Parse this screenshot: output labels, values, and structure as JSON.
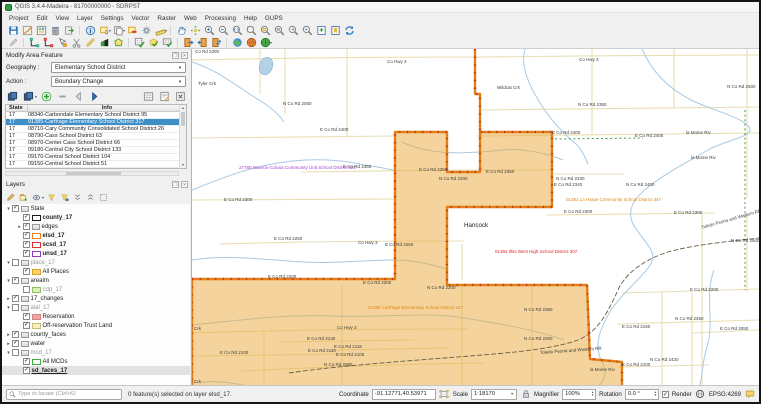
{
  "window": {
    "title": "QGIS 3.4.4-Madeira - 81700000000 - SDRPST"
  },
  "menu": {
    "items": [
      "Project",
      "Edit",
      "View",
      "Layer",
      "Settings",
      "Vector",
      "Raster",
      "Web",
      "Processing",
      "Help",
      "GUPS"
    ]
  },
  "toolbars": {
    "row1": [
      "project-save",
      "style-manager",
      "layout-manager",
      "delete-selected",
      "export-map",
      "|",
      "identify-features",
      "select-features",
      "copy-features",
      "deselect-features",
      "options-gear",
      "measure",
      "|",
      "pan-map",
      "pan-to-selection",
      "zoom-in",
      "zoom-out",
      "zoom-native",
      "zoom-full",
      "zoom-to-selection",
      "zoom-to-layer",
      "zoom-last",
      "zoom-next",
      "new-bookmark",
      "show-bookmarks",
      "map-refresh"
    ],
    "row2": [
      "toggle-editing",
      "|",
      "vertex-tool",
      "vertex-tool-active-layer",
      "modify-features",
      "cut-features",
      "measure-sketch",
      "snapping",
      "add-polygon",
      "|",
      "validate-grid",
      "review-polygon",
      "quality-grid",
      "|",
      "import-door",
      "export-door",
      "transfer-door",
      "|",
      "web-globe",
      "orange-sphere",
      "green-sphere"
    ]
  },
  "modify_panel": {
    "title": "Modify Area Feature",
    "geography_label": "Geography :",
    "geography_value": "Elementary School District",
    "action_label": "Action :",
    "action_value": "Boundary Change",
    "buttons": [
      "copy-selection",
      "copy-selection-menu",
      "add-area",
      "remove-area",
      "previous-feature",
      "next-feature",
      "spacer",
      "attribute-table",
      "edit-attributes",
      "close-tool"
    ],
    "table": {
      "columns": [
        "State",
        "Info"
      ],
      "selected_index": 1,
      "rows": [
        {
          "state": "17",
          "info": "08340-Carbondale Elementary School District 95"
        },
        {
          "state": "17",
          "info": "01385-Carthage Elementary School District 317"
        },
        {
          "state": "17",
          "info": "08710-Cary Community Consolidated School District 26"
        },
        {
          "state": "17",
          "info": "08790-Cass School District 63"
        },
        {
          "state": "17",
          "info": "08970-Center Cass School District 66"
        },
        {
          "state": "17",
          "info": "09180-Central City School District 133"
        },
        {
          "state": "17",
          "info": "09170-Central School District 104"
        },
        {
          "state": "17",
          "info": "09150-Central School District 51"
        }
      ]
    }
  },
  "layers_panel": {
    "title": "Layers",
    "toolbar": [
      "open-layer-styling",
      "add-group",
      "manage-map-themes",
      "filter-legend",
      "filter-expression",
      "expand-all",
      "collapse-all",
      "remove-layer"
    ],
    "tree": [
      {
        "label": "State",
        "indent": 0,
        "expander": "open",
        "checked": true,
        "swatch": "group"
      },
      {
        "label": "county_17",
        "indent": 1,
        "checked": true,
        "swatch": "outline",
        "color": "#1a1a1a",
        "bold": true
      },
      {
        "label": "edges",
        "indent": 1,
        "expander": "closed",
        "checked": true,
        "swatch": "group"
      },
      {
        "label": "elsd_17",
        "indent": 1,
        "checked": true,
        "swatch": "outline",
        "color": "#e8821e",
        "bold": true
      },
      {
        "label": "scsd_17",
        "indent": 1,
        "checked": true,
        "swatch": "outline",
        "color": "#e03030",
        "bold": true
      },
      {
        "label": "unsd_17",
        "indent": 1,
        "checked": true,
        "swatch": "outline",
        "color": "#8f3fbf",
        "bold": true
      },
      {
        "label": "place_17",
        "indent": 0,
        "expander": "open",
        "checked": false,
        "swatch": "group",
        "gray": true
      },
      {
        "label": "All Places",
        "indent": 1,
        "checked": true,
        "swatch": "fill",
        "color": "#f8d66a",
        "border": "#dd9f20"
      },
      {
        "label": "arealm",
        "indent": 0,
        "expander": "open",
        "checked": true,
        "swatch": "group"
      },
      {
        "label": "cdp_17",
        "indent": 1,
        "checked": false,
        "swatch": "fill",
        "color": "#d8f0c0",
        "border": "#8fbf60",
        "gray": true
      },
      {
        "label": "17_changes",
        "indent": 0,
        "expander": "closed",
        "checked": true,
        "swatch": "group"
      },
      {
        "label": "aial_17",
        "indent": 0,
        "expander": "open",
        "checked": false,
        "swatch": "group",
        "gray": true
      },
      {
        "label": "Reservation",
        "indent": 1,
        "checked": true,
        "swatch": "fill",
        "color": "#f4a3a0",
        "border": "#cc8884"
      },
      {
        "label": "Off-reservation Trust Land",
        "indent": 1,
        "checked": true,
        "swatch": "fill",
        "color": "#f4eecb",
        "border": "#c9c070"
      },
      {
        "label": "county_faces",
        "indent": 0,
        "expander": "closed",
        "checked": true,
        "swatch": "group"
      },
      {
        "label": "water",
        "indent": 0,
        "expander": "closed",
        "checked": true,
        "swatch": "group"
      },
      {
        "label": "mcd_17",
        "indent": 0,
        "expander": "open",
        "checked": false,
        "swatch": "group",
        "gray": true
      },
      {
        "label": "All MCDs",
        "indent": 1,
        "checked": true,
        "swatch": "outline",
        "color": "#3faf3f"
      },
      {
        "label": "sd_faces_17",
        "indent": 1,
        "checked": true,
        "swatch": "none",
        "bold": true,
        "underline": true,
        "selected": true
      }
    ]
  },
  "status_bar": {
    "locate_placeholder": "Type to locate (Ctrl+K)",
    "message": "0 feature(s) selected on layer elsd_17.",
    "coordinate_label": "Coordinate",
    "coordinate_value": "-91.12771,40.53971",
    "scale_label": "Scale",
    "scale_value": "1:18170",
    "magnifier_label": "Magnifier",
    "magnifier_value": "100%",
    "rotation_label": "Rotation",
    "rotation_value": "0.0 °",
    "render_label": "Render",
    "render_checked": true,
    "crs": "EPSG:4269"
  },
  "map": {
    "county_name": "Hancock",
    "colors": {
      "district_fill": "#e9a939",
      "district_border": "#df7f16",
      "red_dash": "#cf2a1a",
      "roads": "#e8dfb4",
      "water": "#a9c9e2",
      "railroad": "#6a5c45",
      "green_boundary": "#2f8f2f"
    },
    "label_colors": {
      "road": "#3d3d3d",
      "purple": "#a93ecf",
      "orange": "#e0860a",
      "red": "#e02222",
      "place": "#222222"
    },
    "labels": [
      {
        "t": "Co Rd 2300",
        "x": 193,
        "y": 51
      },
      {
        "t": "Tyler Crk",
        "x": 196,
        "y": 83
      },
      {
        "t": "N Co Rd 2050",
        "x": 281,
        "y": 103
      },
      {
        "t": "Co Hwy 3",
        "x": 385,
        "y": 61
      },
      {
        "t": "Co Hwy 3",
        "x": 577,
        "y": 59
      },
      {
        "t": "Wildcat Crk",
        "x": 495,
        "y": 87
      },
      {
        "t": "N Co Rd 2500",
        "x": 725,
        "y": 86
      },
      {
        "t": "N Co Rd 2350",
        "x": 576,
        "y": 104
      },
      {
        "t": "E Co Rd 2400",
        "x": 318,
        "y": 129
      },
      {
        "t": "E Co Rd 2400",
        "x": 550,
        "y": 132
      },
      {
        "t": "E Co Rd 2400",
        "x": 633,
        "y": 135
      },
      {
        "t": "la Moine Riv",
        "x": 684,
        "y": 132
      },
      {
        "t": "la Moine Riv",
        "x": 689,
        "y": 157
      },
      {
        "t": "27780 Nauvoo-Colusa Community Unit School District 325",
        "x": 237,
        "y": 167,
        "c": "purple"
      },
      {
        "t": "E Co Rd 2350",
        "x": 341,
        "y": 166
      },
      {
        "t": "E Co Rd 2350",
        "x": 417,
        "y": 169
      },
      {
        "t": "E Co Rd 2350",
        "x": 484,
        "y": 171
      },
      {
        "t": "N Co Rd 2200",
        "x": 437,
        "y": 178
      },
      {
        "t": "N Co Rd 2330",
        "x": 554,
        "y": 178
      },
      {
        "t": "E Co Rd 2340",
        "x": 552,
        "y": 184
      },
      {
        "t": "N Co Rd 2400",
        "x": 624,
        "y": 184
      },
      {
        "t": "E Co Rd 2300",
        "x": 222,
        "y": 199
      },
      {
        "t": "E Co Rd 2300",
        "x": 562,
        "y": 211
      },
      {
        "t": "E Co Rd 2300",
        "x": 672,
        "y": 212
      },
      {
        "t": "01381 La Harpe Community School District 347",
        "x": 564,
        "y": 199,
        "c": "orange"
      },
      {
        "t": "Hancock",
        "x": 462,
        "y": 225,
        "c": "place",
        "s": 6.2
      },
      {
        "t": "Toledo Peoria and Western RR",
        "x": 700,
        "y": 227,
        "r": -16
      },
      {
        "t": "N Co Rd 2500",
        "x": 729,
        "y": 240
      },
      {
        "t": "01384 Illini West High School District 307",
        "x": 493,
        "y": 251,
        "c": "red"
      },
      {
        "t": "E Co Rd 2250",
        "x": 272,
        "y": 238
      },
      {
        "t": "Co Hwy 3",
        "x": 356,
        "y": 242
      },
      {
        "t": "E Co Rd 2250",
        "x": 383,
        "y": 244
      },
      {
        "t": "E Co Rd 2200",
        "x": 266,
        "y": 276
      },
      {
        "t": "E Co Rd 2200",
        "x": 361,
        "y": 282
      },
      {
        "t": "N Co Rd 2200",
        "x": 425,
        "y": 287
      },
      {
        "t": "E Co Rd 2200",
        "x": 688,
        "y": 289
      },
      {
        "t": "01385 Carthage Elementary School District 317",
        "x": 366,
        "y": 307,
        "c": "orange"
      },
      {
        "t": "N Co Rd 2380",
        "x": 522,
        "y": 309
      },
      {
        "t": "N Co Rd 2450",
        "x": 673,
        "y": 318
      },
      {
        "t": "E Co Rd 2150",
        "x": 620,
        "y": 326
      },
      {
        "t": "E Co Rd 2050",
        "x": 718,
        "y": 328
      },
      {
        "t": "Co Hwy 3",
        "x": 335,
        "y": 327
      },
      {
        "t": "E Co Rd 2130",
        "x": 305,
        "y": 338
      },
      {
        "t": "N Co Rd 2300",
        "x": 522,
        "y": 338
      },
      {
        "t": "E Co Rd 2115",
        "x": 332,
        "y": 346
      },
      {
        "t": "E Co Rd 2110",
        "x": 306,
        "y": 350
      },
      {
        "t": "E Co Rd 2105",
        "x": 334,
        "y": 354
      },
      {
        "t": "E Co Rd 2100",
        "x": 218,
        "y": 352
      },
      {
        "t": "Toledo Peoria and Western RR",
        "x": 538,
        "y": 352,
        "r": -4
      },
      {
        "t": "N Co Rd 2095",
        "x": 322,
        "y": 364
      },
      {
        "t": "N Co Rd 2420",
        "x": 648,
        "y": 359
      },
      {
        "t": "E Co Rd 2100",
        "x": 620,
        "y": 364
      },
      {
        "t": "la Moine Riv",
        "x": 588,
        "y": 369
      },
      {
        "t": "Crk",
        "x": 192,
        "y": 328
      },
      {
        "t": "Crk",
        "x": 192,
        "y": 381
      },
      {
        "t": "E Co Rd 2065",
        "x": 352,
        "y": 386
      }
    ]
  }
}
